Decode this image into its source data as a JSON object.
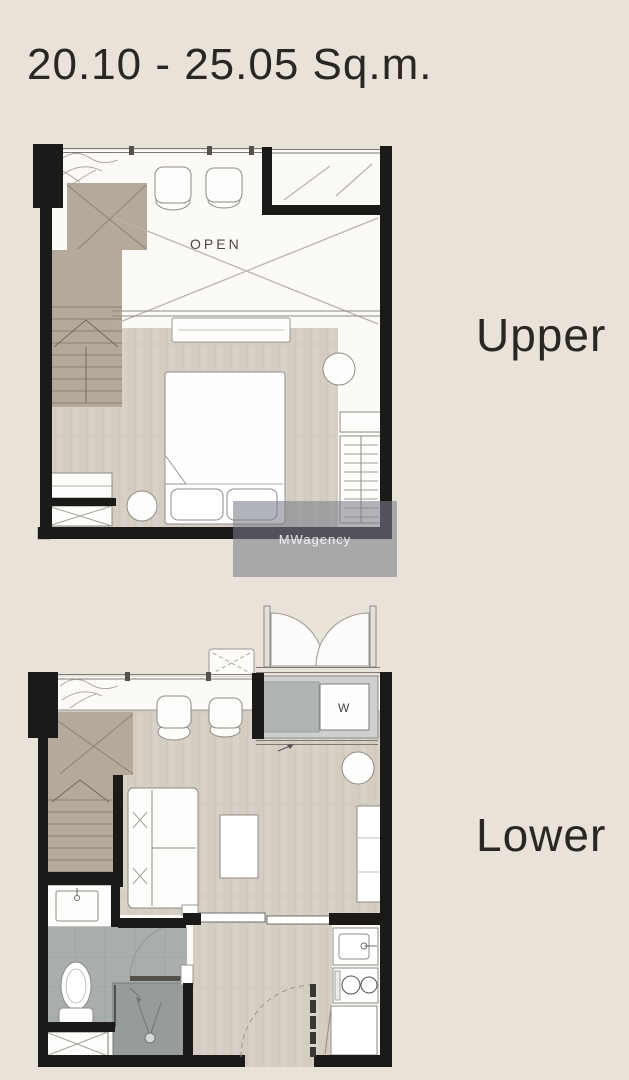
{
  "page": {
    "title": "20.10 - 25.05 Sq.m.",
    "background_color": "#e8e2d9"
  },
  "plans": {
    "upper": {
      "label": "Upper",
      "open_label": "OPEN"
    },
    "lower": {
      "label": "Lower",
      "washer_label": "W"
    }
  },
  "watermark": {
    "text": "MWagency"
  },
  "colors": {
    "wall": "#1b1a18",
    "plan_floor_white": "#fbfaf7",
    "wood_floor": "#d8d1c7",
    "stair_tan": "#b4a99a",
    "bath_tile": "#a9aeac",
    "shower_gray": "#969c9b",
    "washer_gray": "#b0b4b3",
    "title_text": "#2a2723",
    "watermark_bg": "rgba(122,126,137,0.58)"
  }
}
